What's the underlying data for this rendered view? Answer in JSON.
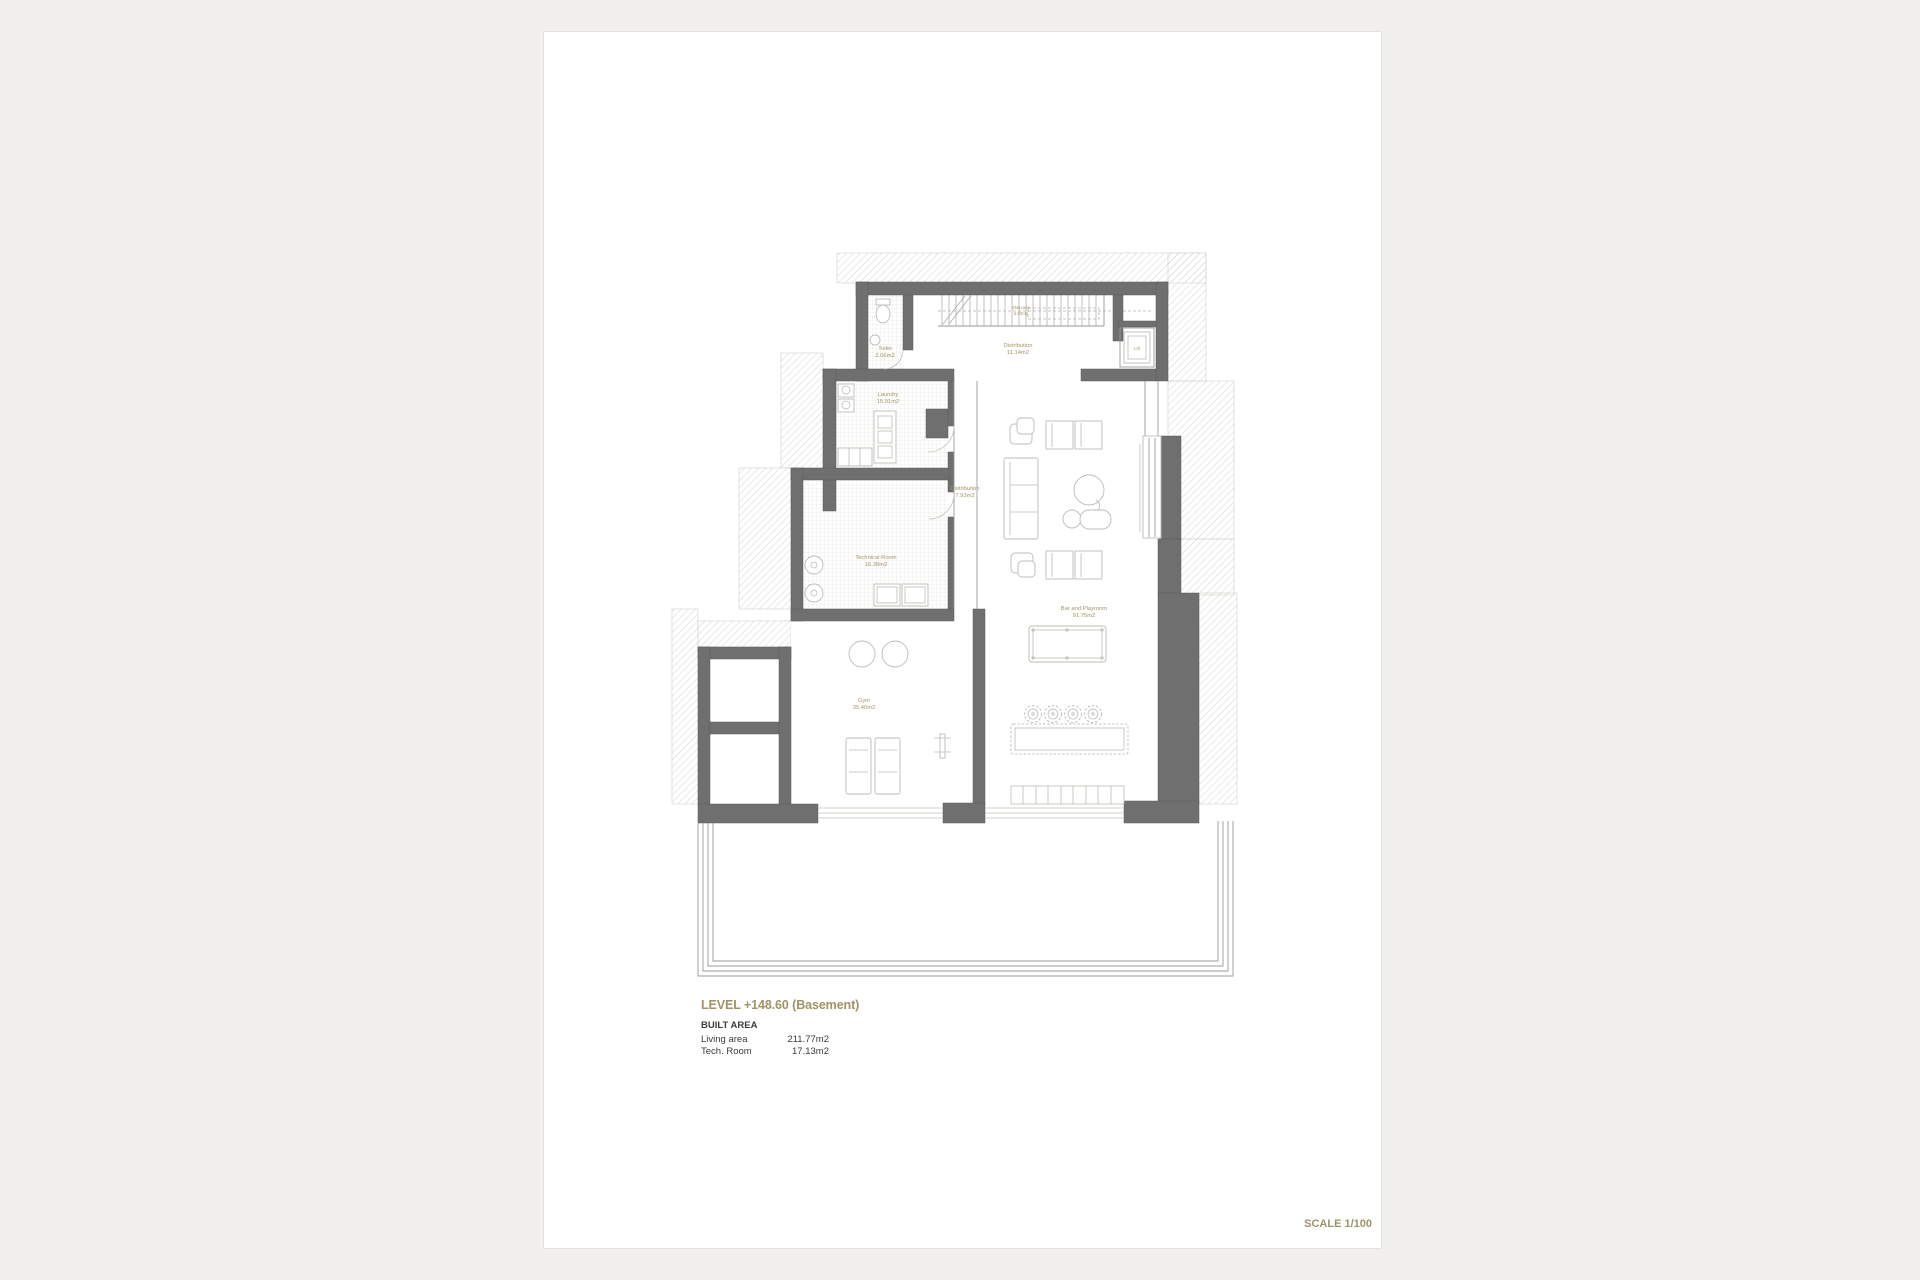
{
  "title_block": {
    "level_title": "LEVEL +148.60 (Basement)",
    "built_area_heading": "BUILT AREA",
    "areas": [
      {
        "label": "Living area",
        "value": "211.77m2"
      },
      {
        "label": "Tech. Room",
        "value": "17.13m2"
      }
    ]
  },
  "scale_label": "SCALE 1/100",
  "colors": {
    "accent_gold": "#a19166",
    "wall_gray": "#6f6f6f",
    "paper_white": "#ffffff",
    "canvas_background": "#f1f0ee"
  },
  "plan": {
    "rooms": {
      "staircase": {
        "name": "Staircase",
        "area": "5.80m2"
      },
      "toilet": {
        "name": "Toilet",
        "area": "2.06m2"
      },
      "distribution_upper": {
        "name": "Distribution",
        "area": "11.14m2"
      },
      "lift": {
        "name": "Lift"
      },
      "laundry": {
        "name": "Laundry",
        "area": "15.91m2"
      },
      "distribution_lower": {
        "name": "Distribution",
        "area": "7.93m2"
      },
      "technical_room": {
        "name": "Technical Room",
        "area": "16.38m2"
      },
      "bar_playroom": {
        "name": "Bar and Playroom",
        "area": "91.75m2"
      },
      "gym": {
        "name": "Gym",
        "area": "35.40m2"
      }
    }
  }
}
